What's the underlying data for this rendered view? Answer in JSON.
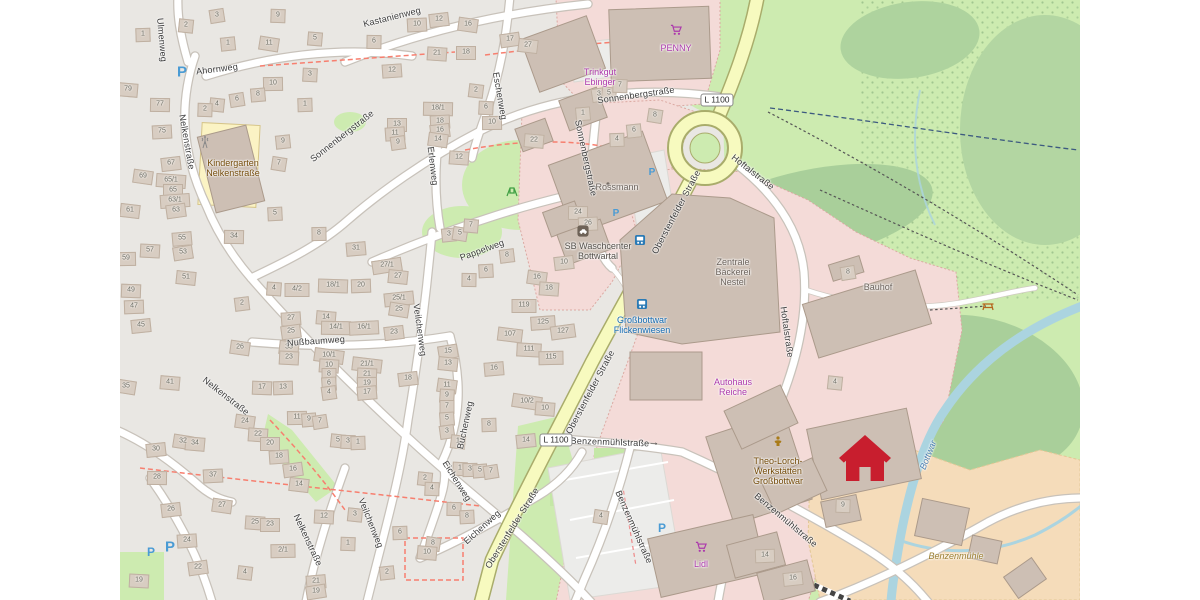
{
  "map": {
    "colors": {
      "shop": "#ac39ac",
      "amenity": "#734a08",
      "amenity_dark": "#54504a",
      "building": "#6b625b",
      "industrial": "#6b625b",
      "transit": "#1269b0",
      "water": "#4d80b3",
      "farm": "#9a7d2e"
    },
    "road_badges": [
      {
        "t": "L 1100",
        "x": 597,
        "y": 100
      },
      {
        "t": "L 1100",
        "x": 436,
        "y": 440
      }
    ],
    "street_labels": [
      {
        "t": "Ulmenweg",
        "x": 42,
        "y": 40,
        "r": 85
      },
      {
        "t": "Ahornweg",
        "x": 97,
        "y": 69,
        "r": -7
      },
      {
        "t": "Kastanienweg",
        "x": 272,
        "y": 17,
        "r": -14
      },
      {
        "t": "Nelkenstraße",
        "x": 67,
        "y": 142,
        "r": 80
      },
      {
        "t": "Sonnenbergstraße",
        "x": 222,
        "y": 136,
        "r": -38
      },
      {
        "t": "Erlenweg",
        "x": 313,
        "y": 166,
        "r": 83
      },
      {
        "t": "Eschenweg",
        "x": 380,
        "y": 96,
        "r": 80
      },
      {
        "t": "Sonnenbergstraße",
        "x": 516,
        "y": 95,
        "r": -8
      },
      {
        "t": "Sonnenbergstraße",
        "x": 466,
        "y": 158,
        "r": 78
      },
      {
        "t": "Oberstenfelder Straße",
        "x": 556,
        "y": 212,
        "r": -62
      },
      {
        "t": "Oberstenfelder Straße",
        "x": 470,
        "y": 392,
        "r": -62
      },
      {
        "t": "Oberstenfelder Straße",
        "x": 392,
        "y": 528,
        "r": -58
      },
      {
        "t": "Hoftalstraße",
        "x": 633,
        "y": 172,
        "r": 38
      },
      {
        "t": "Hoftalstraße",
        "x": 667,
        "y": 332,
        "r": 82
      },
      {
        "t": "Pappelweg",
        "x": 362,
        "y": 250,
        "r": -20
      },
      {
        "t": "Nußbaumweg",
        "x": 196,
        "y": 341,
        "r": -4
      },
      {
        "t": "Veilchenweg",
        "x": 300,
        "y": 330,
        "r": 82
      },
      {
        "t": "Veilchenweg",
        "x": 251,
        "y": 523,
        "r": 68
      },
      {
        "t": "Nelkenstraße",
        "x": 106,
        "y": 396,
        "r": 38
      },
      {
        "t": "Nelkenstraße",
        "x": 188,
        "y": 540,
        "r": 65
      },
      {
        "t": "Buchenweg",
        "x": 345,
        "y": 425,
        "r": -78
      },
      {
        "t": "Eichenweg",
        "x": 337,
        "y": 481,
        "r": 58
      },
      {
        "t": "Eichenweg",
        "x": 362,
        "y": 527,
        "r": -42
      },
      {
        "t": "Benzenmühlstraße",
        "x": 490,
        "y": 442,
        "r": 2
      },
      {
        "t": "Benzenmühlstraße",
        "x": 514,
        "y": 527,
        "r": 66
      },
      {
        "t": "Benzenmühlstraße",
        "x": 666,
        "y": 520,
        "r": 40
      }
    ],
    "pois": [
      {
        "lines": [
          "Kindergarten",
          "Nelkenstraße"
        ],
        "x": 113,
        "y": 168,
        "c": "amenity"
      },
      {
        "lines": [
          "Trinkgut",
          "Ebinger"
        ],
        "x": 480,
        "y": 77,
        "c": "shop"
      },
      {
        "lines": [
          "PENNY"
        ],
        "x": 556,
        "y": 48,
        "c": "shop"
      },
      {
        "lines": [
          "Rossmann"
        ],
        "x": 497,
        "y": 187,
        "c": "building"
      },
      {
        "lines": [
          "SB Waschcenter",
          "Bottwartal"
        ],
        "x": 478,
        "y": 251,
        "c": "amenity_dark"
      },
      {
        "lines": [
          "Zentrale",
          "Bäckerei",
          "Nestel"
        ],
        "x": 613,
        "y": 272,
        "c": "industrial"
      },
      {
        "lines": [
          "Bauhof"
        ],
        "x": 758,
        "y": 287,
        "c": "industrial"
      },
      {
        "lines": [
          "Großbottwar",
          "Flickenwiesen"
        ],
        "x": 522,
        "y": 325,
        "c": "transit"
      },
      {
        "lines": [
          "Autohaus",
          "Reiche"
        ],
        "x": 613,
        "y": 387,
        "c": "shop"
      },
      {
        "lines": [
          "Theo-Lorch-",
          "Werkstätten",
          "Großbottwar"
        ],
        "x": 658,
        "y": 471,
        "c": "amenity"
      },
      {
        "lines": [
          "Lidl"
        ],
        "x": 581,
        "y": 564,
        "c": "shop"
      },
      {
        "lines": [
          "Benzenmühle"
        ],
        "x": 836,
        "y": 556,
        "c": "farm"
      },
      {
        "lines": [
          "Bottwar"
        ],
        "x": 808,
        "y": 455,
        "c": "water",
        "r": -68
      }
    ],
    "icon_defs": {
      "parking": "P",
      "arrow": "→"
    },
    "icons": [
      {
        "t": "parking",
        "x": 62,
        "y": 72,
        "s": 15
      },
      {
        "t": "parking",
        "x": 532,
        "y": 173,
        "s": 10
      },
      {
        "t": "parking",
        "x": 496,
        "y": 214,
        "s": 10
      },
      {
        "t": "parking",
        "x": 542,
        "y": 528,
        "s": 12
      },
      {
        "t": "parking",
        "x": 31,
        "y": 552,
        "s": 12
      },
      {
        "t": "parking",
        "x": 50,
        "y": 547,
        "s": 15
      },
      {
        "t": "arrow",
        "x": 534,
        "y": 443,
        "s": 11
      },
      {
        "t": "bus",
        "x": 520,
        "y": 240
      },
      {
        "t": "bus",
        "x": 522,
        "y": 304
      },
      {
        "t": "cart",
        "x": 556,
        "y": 30
      },
      {
        "t": "cart",
        "x": 581,
        "y": 547
      },
      {
        "t": "carwash",
        "x": 463,
        "y": 231
      },
      {
        "t": "mast",
        "x": 85,
        "y": 142
      },
      {
        "t": "picnic",
        "x": 868,
        "y": 306
      },
      {
        "t": "playground",
        "x": 392,
        "y": 192
      },
      {
        "t": "social",
        "x": 658,
        "y": 441
      },
      {
        "t": "home",
        "x": 745,
        "y": 458
      }
    ],
    "house_numbers": [
      [
        97,
        15,
        "3"
      ],
      [
        66,
        25,
        "2"
      ],
      [
        158,
        15,
        "9"
      ],
      [
        23,
        34,
        "1"
      ],
      [
        108,
        43,
        "1"
      ],
      [
        149,
        43,
        "11"
      ],
      [
        195,
        38,
        "5"
      ],
      [
        254,
        41,
        "6"
      ],
      [
        297,
        24,
        "10"
      ],
      [
        319,
        19,
        "12"
      ],
      [
        348,
        24,
        "16"
      ],
      [
        317,
        53,
        "21"
      ],
      [
        346,
        52,
        "18"
      ],
      [
        272,
        70,
        "12"
      ],
      [
        390,
        39,
        "17"
      ],
      [
        408,
        45,
        "27"
      ],
      [
        190,
        74,
        "3"
      ],
      [
        153,
        83,
        "10"
      ],
      [
        138,
        94,
        "8"
      ],
      [
        117,
        99,
        "6"
      ],
      [
        97,
        104,
        "4"
      ],
      [
        85,
        109,
        "2"
      ],
      [
        185,
        104,
        "1"
      ],
      [
        163,
        141,
        "9"
      ],
      [
        159,
        163,
        "7"
      ],
      [
        8,
        89,
        "79"
      ],
      [
        40,
        104,
        "77"
      ],
      [
        42,
        131,
        "75"
      ],
      [
        51,
        163,
        "67"
      ],
      [
        23,
        176,
        "69"
      ],
      [
        51,
        180,
        "65/1"
      ],
      [
        53,
        190,
        "65"
      ],
      [
        55,
        200,
        "63/1"
      ],
      [
        56,
        210,
        "63"
      ],
      [
        10,
        210,
        "61"
      ],
      [
        30,
        250,
        "57"
      ],
      [
        6,
        258,
        "59"
      ],
      [
        62,
        238,
        "55"
      ],
      [
        63,
        252,
        "53"
      ],
      [
        66,
        277,
        "51"
      ],
      [
        11,
        290,
        "49"
      ],
      [
        14,
        306,
        "47"
      ],
      [
        21,
        325,
        "45"
      ],
      [
        6,
        386,
        "35"
      ],
      [
        50,
        382,
        "41"
      ],
      [
        114,
        236,
        "34"
      ],
      [
        155,
        213,
        "5"
      ],
      [
        122,
        303,
        "2"
      ],
      [
        120,
        347,
        "26"
      ],
      [
        154,
        288,
        "4"
      ],
      [
        177,
        289,
        "4/2"
      ],
      [
        171,
        318,
        "27"
      ],
      [
        171,
        331,
        "25"
      ],
      [
        169,
        347,
        "33"
      ],
      [
        169,
        357,
        "23"
      ],
      [
        199,
        233,
        "8"
      ],
      [
        236,
        248,
        "31"
      ],
      [
        267,
        265,
        "27/1"
      ],
      [
        278,
        276,
        "27"
      ],
      [
        213,
        285,
        "18/1"
      ],
      [
        241,
        285,
        "20"
      ],
      [
        279,
        298,
        "25/1"
      ],
      [
        279,
        309,
        "25"
      ],
      [
        206,
        317,
        "14"
      ],
      [
        216,
        327,
        "14/1"
      ],
      [
        244,
        327,
        "16/1"
      ],
      [
        274,
        332,
        "23"
      ],
      [
        209,
        355,
        "10/1"
      ],
      [
        209,
        365,
        "10"
      ],
      [
        209,
        374,
        "8"
      ],
      [
        209,
        383,
        "6"
      ],
      [
        209,
        392,
        "4"
      ],
      [
        247,
        364,
        "21/1"
      ],
      [
        247,
        374,
        "21"
      ],
      [
        247,
        383,
        "19"
      ],
      [
        247,
        392,
        "17"
      ],
      [
        328,
        351,
        "15"
      ],
      [
        328,
        363,
        "13"
      ],
      [
        142,
        387,
        "17"
      ],
      [
        163,
        387,
        "13"
      ],
      [
        329,
        234,
        "3"
      ],
      [
        340,
        233,
        "5"
      ],
      [
        351,
        225,
        "7"
      ],
      [
        349,
        279,
        "4"
      ],
      [
        366,
        270,
        "6"
      ],
      [
        387,
        255,
        "8"
      ],
      [
        125,
        421,
        "24"
      ],
      [
        138,
        434,
        "22"
      ],
      [
        150,
        443,
        "20"
      ],
      [
        159,
        456,
        "18"
      ],
      [
        173,
        469,
        "16"
      ],
      [
        179,
        484,
        "14"
      ],
      [
        204,
        516,
        "12"
      ],
      [
        177,
        417,
        "11"
      ],
      [
        189,
        419,
        "9"
      ],
      [
        200,
        421,
        "7"
      ],
      [
        218,
        440,
        "5"
      ],
      [
        228,
        441,
        "3"
      ],
      [
        238,
        442,
        "1"
      ],
      [
        36,
        449,
        "30"
      ],
      [
        63,
        441,
        "32"
      ],
      [
        75,
        443,
        "34"
      ],
      [
        37,
        477,
        "28"
      ],
      [
        93,
        475,
        "37"
      ],
      [
        51,
        509,
        "26"
      ],
      [
        102,
        505,
        "27"
      ],
      [
        135,
        522,
        "25"
      ],
      [
        150,
        524,
        "23"
      ],
      [
        67,
        540,
        "24"
      ],
      [
        78,
        567,
        "22"
      ],
      [
        125,
        572,
        "4"
      ],
      [
        19,
        580,
        "19"
      ],
      [
        163,
        550,
        "2/1"
      ],
      [
        196,
        581,
        "21"
      ],
      [
        196,
        591,
        "19"
      ],
      [
        235,
        514,
        "3"
      ],
      [
        228,
        543,
        "1"
      ],
      [
        280,
        532,
        "6"
      ],
      [
        267,
        572,
        "2"
      ],
      [
        313,
        543,
        "8"
      ],
      [
        307,
        552,
        "10"
      ],
      [
        334,
        508,
        "6"
      ],
      [
        347,
        516,
        "8"
      ],
      [
        288,
        378,
        "18"
      ],
      [
        327,
        385,
        "11"
      ],
      [
        327,
        395,
        "9"
      ],
      [
        327,
        406,
        "7"
      ],
      [
        327,
        418,
        "5"
      ],
      [
        327,
        431,
        "3"
      ],
      [
        338,
        441,
        "1"
      ],
      [
        340,
        468,
        "1"
      ],
      [
        350,
        469,
        "3"
      ],
      [
        360,
        470,
        "5"
      ],
      [
        371,
        471,
        "7"
      ],
      [
        305,
        478,
        "2"
      ],
      [
        312,
        488,
        "4"
      ],
      [
        369,
        424,
        "8"
      ],
      [
        406,
        440,
        "14"
      ],
      [
        407,
        401,
        "10/2"
      ],
      [
        425,
        408,
        "10"
      ],
      [
        318,
        108,
        "18/1"
      ],
      [
        320,
        121,
        "18"
      ],
      [
        320,
        130,
        "16"
      ],
      [
        318,
        139,
        "14"
      ],
      [
        339,
        157,
        "12"
      ],
      [
        277,
        124,
        "13"
      ],
      [
        275,
        133,
        "11"
      ],
      [
        278,
        142,
        "9"
      ],
      [
        356,
        90,
        "2"
      ],
      [
        366,
        107,
        "6"
      ],
      [
        372,
        122,
        "10"
      ],
      [
        463,
        113,
        "1"
      ],
      [
        479,
        94,
        "3"
      ],
      [
        489,
        93,
        "5"
      ],
      [
        500,
        85,
        "7"
      ],
      [
        497,
        139,
        "4"
      ],
      [
        514,
        130,
        "6"
      ],
      [
        535,
        115,
        "8"
      ],
      [
        414,
        140,
        "22"
      ],
      [
        458,
        212,
        "24"
      ],
      [
        468,
        223,
        "26"
      ],
      [
        444,
        262,
        "10"
      ],
      [
        417,
        277,
        "16"
      ],
      [
        429,
        288,
        "18"
      ],
      [
        404,
        305,
        "119"
      ],
      [
        423,
        322,
        "125"
      ],
      [
        443,
        331,
        "127"
      ],
      [
        390,
        334,
        "107"
      ],
      [
        409,
        349,
        "111"
      ],
      [
        431,
        357,
        "115"
      ],
      [
        374,
        368,
        "16"
      ],
      [
        728,
        272,
        "8"
      ],
      [
        715,
        382,
        "4"
      ],
      [
        723,
        505,
        "9"
      ],
      [
        645,
        555,
        "14"
      ],
      [
        673,
        578,
        "16"
      ],
      [
        481,
        516,
        "4"
      ]
    ]
  }
}
